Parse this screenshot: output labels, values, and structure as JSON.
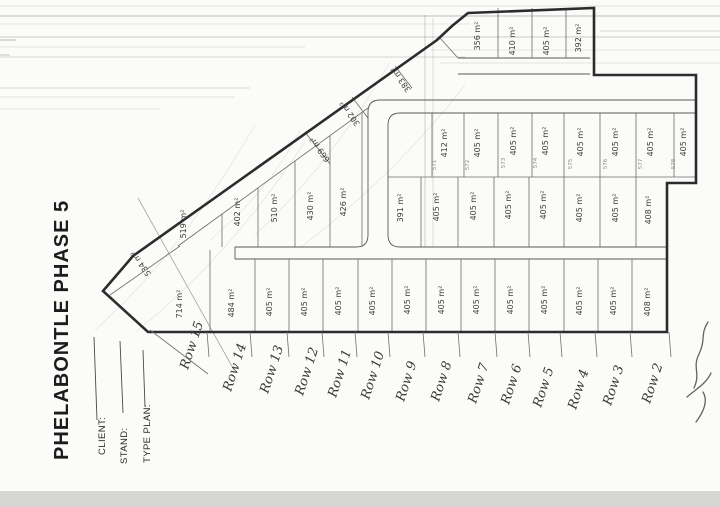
{
  "scan": {
    "title": "PHELABONTLE PHASE 5",
    "form_fields": [
      {
        "label": "CLIENT:"
      },
      {
        "label": "STAND:"
      },
      {
        "label": "TYPE PLAN:"
      }
    ],
    "row_labels": [
      "Row 15",
      "Row 14",
      "Row 13",
      "Row 12",
      "Row 11",
      "Row 10",
      "Row 9",
      "Row 8",
      "Row 7",
      "Row 6",
      "Row 5",
      "Row 4",
      "Row 3",
      "Row 2"
    ],
    "lot_areas": {
      "bottom_row": [
        "714 m²",
        "484 m²",
        "405 m²",
        "405 m²",
        "405 m²",
        "405 m²",
        "405 m²",
        "405 m²",
        "405 m²",
        "405 m²",
        "405 m²",
        "405 m²",
        "405 m²",
        "408 m²"
      ],
      "middle_left_row": [
        "519 m²",
        "402 m²",
        "510 m²",
        "430 m²",
        "426 m²"
      ],
      "middle_right_row": [
        "391 m²",
        "405 m²",
        "405 m²",
        "405 m²",
        "405 m²",
        "405 m²",
        "405 m²",
        "408 m²"
      ],
      "upper_row": [
        "412 m²",
        "405 m²",
        "405 m²",
        "405 m²",
        "405 m²",
        "405 m²",
        "405 m²",
        "405 m²"
      ],
      "top_row": [
        "356 m²",
        "410 m²",
        "405 m²",
        "392 m²"
      ],
      "edge_lots": [
        "383 m²",
        "302 m²",
        "669 m²",
        "534 m²"
      ]
    },
    "stand_numbers_upper_row": [
      "571",
      "572",
      "573",
      "574",
      "575",
      "576",
      "577",
      "578"
    ]
  }
}
